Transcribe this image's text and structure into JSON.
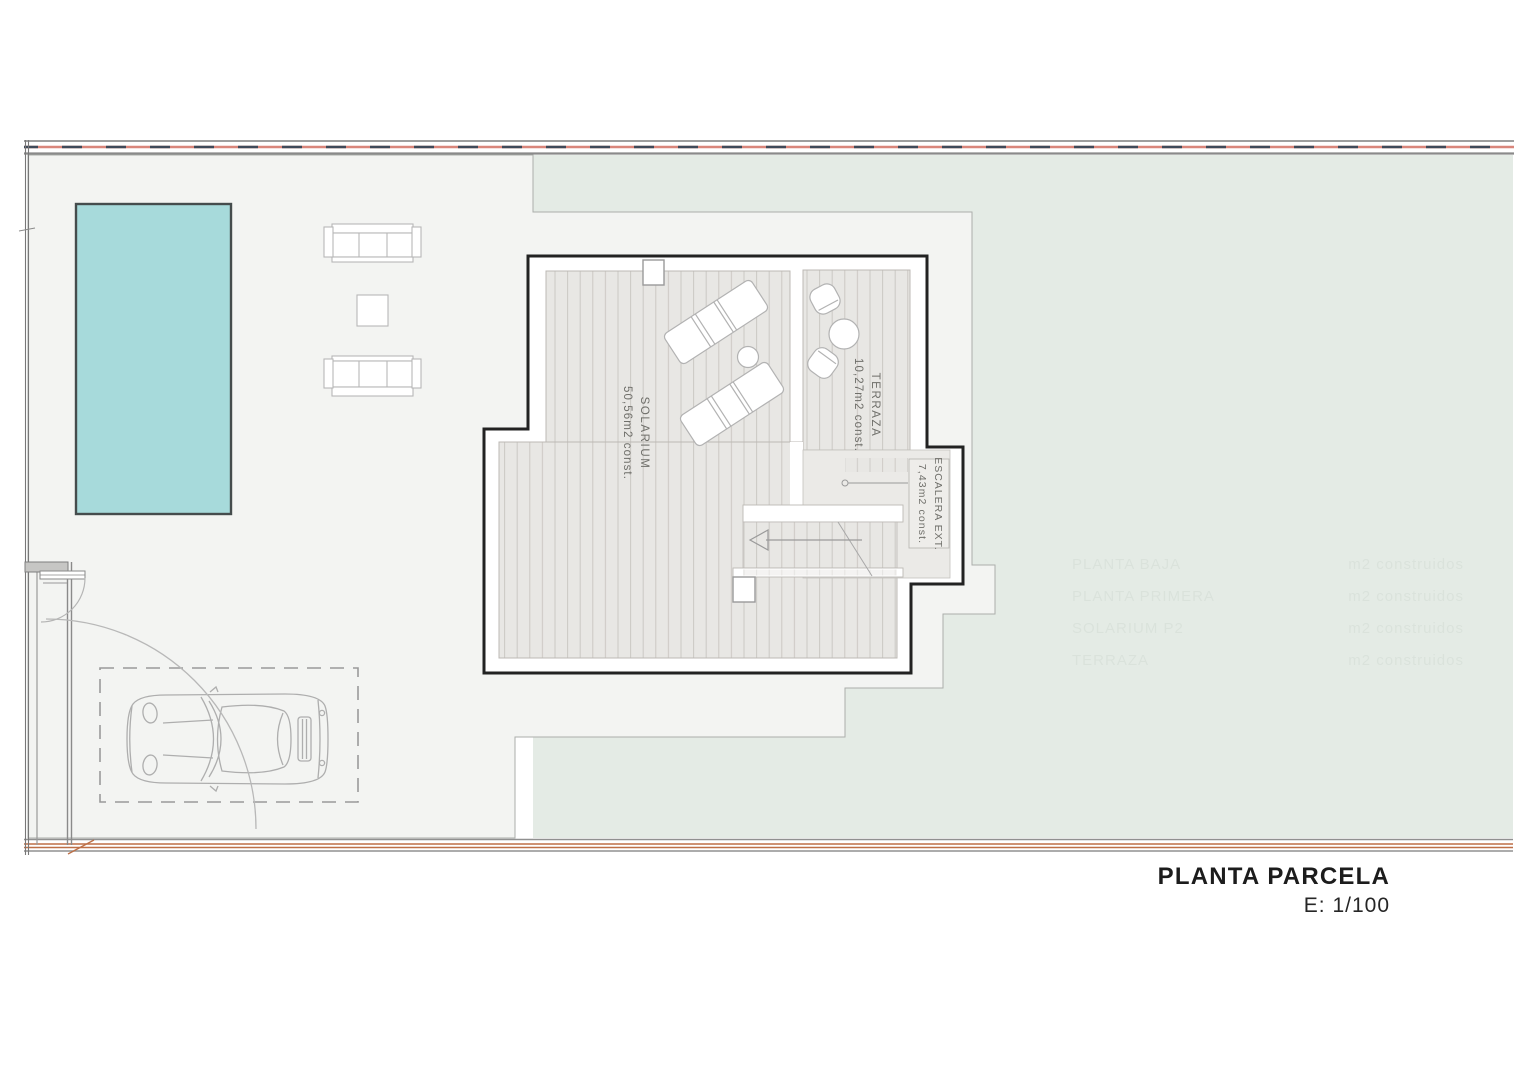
{
  "title_block": {
    "title": "PLANTA PARCELA",
    "scale": "E: 1/100"
  },
  "labels": {
    "solarium": {
      "line1": "SOLARIUM",
      "line2": "50,56m2 const."
    },
    "terraza": {
      "line1": "TERRAZA",
      "line2": "10,27m2 const."
    },
    "escalera": {
      "line1": "ESCALERA EXT.",
      "line2": "7,43m2 const."
    }
  },
  "watermark": {
    "rows": [
      {
        "label": "PLANTA BAJA",
        "value": "m2 construidos"
      },
      {
        "label": "PLANTA PRIMERA",
        "value": "m2 construidos"
      },
      {
        "label": "SOLARIUM P2",
        "value": "m2 construidos"
      },
      {
        "label": "TERRAZA",
        "value": "m2 construidos"
      }
    ]
  },
  "colors": {
    "paving_gray": "#f3f4f2",
    "lawn_green": "#e4ebe5",
    "pool_fill": "#a7dadb",
    "pool_border": "#454c4d",
    "deck_base": "#e8e7e4",
    "deck_stripe": "#cbc8c3",
    "escalera_fill": "#ebeae7",
    "building_outline": "#222222",
    "boundary_red": "#d9867b",
    "boundary_dash_navy": "#3f4a59",
    "boundary_orange": "#bd6f46",
    "boundary_gray": "#8f8f8f",
    "furniture_stroke": "#b7b7b7"
  }
}
